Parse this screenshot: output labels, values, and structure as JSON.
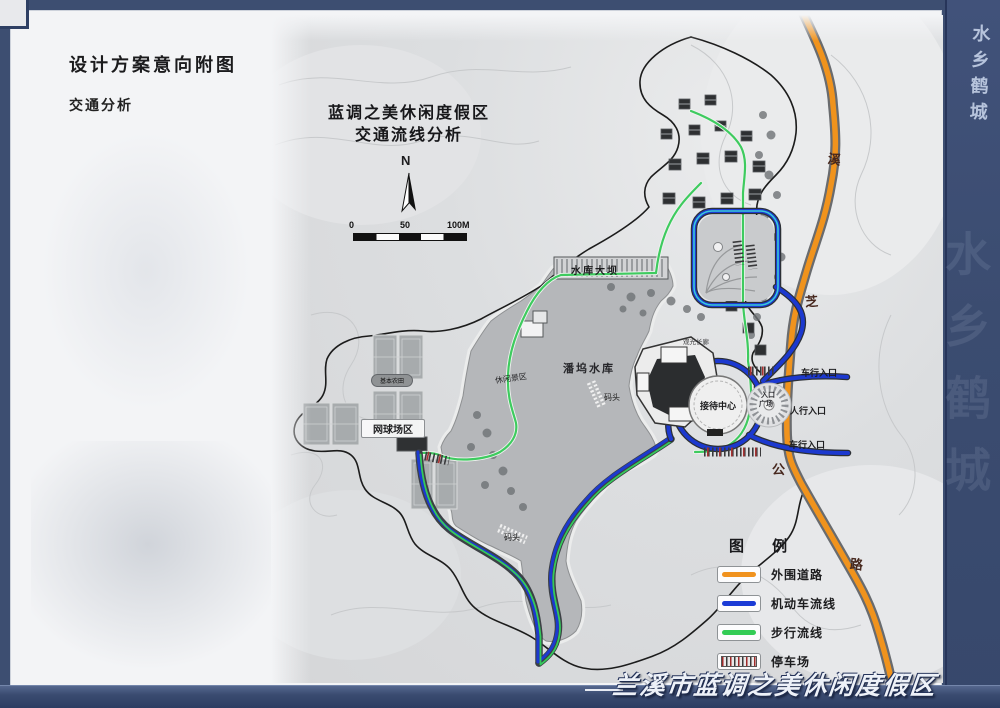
{
  "page": {
    "title": "设计方案意向附图",
    "subtitle": "交通分析",
    "side_calligraphy": "水乡鹤城",
    "footer_calligraphy": "兰溪市蓝调之美休闲度假区"
  },
  "map": {
    "title_line1": "蓝调之美休闲度假区",
    "title_line2": "交通流线分析",
    "north_label": "N",
    "scale_labels": {
      "start": "0",
      "mid": "50",
      "end": "100M"
    },
    "labels": {
      "dam": "水库大坝",
      "reservoir": "潘坞水库",
      "tennis_area": "网球场区",
      "reception": "接待中心",
      "dock_upper": "码头",
      "dock_lower": "码头",
      "plaza_line1": "入口",
      "plaza_line2": "广场",
      "entrance_car_upper": "车行入口",
      "entrance_pedestrian": "人行入口",
      "entrance_car_lower": "车行入口",
      "farmland_badge": "基本农田",
      "scenic_zone": "休闲景区",
      "corridor": "观光长廊"
    },
    "highway_chars": [
      "溪",
      "芝",
      "公",
      "路"
    ]
  },
  "legend": {
    "title": "图  例",
    "items": [
      {
        "label": "外围道路",
        "color": "#f0921e"
      },
      {
        "label": "机动车流线",
        "color": "#1b3bd6"
      },
      {
        "label": "步行流线",
        "color": "#33cc55"
      },
      {
        "label": "停车场",
        "color": "striped"
      }
    ]
  },
  "colors": {
    "frame_navy": "#3d4e71",
    "outer_road_orange": "#f0921e",
    "motor_blue": "#1b3bd6",
    "walk_green": "#33cc55",
    "water_gray": "#b5b7ba"
  }
}
